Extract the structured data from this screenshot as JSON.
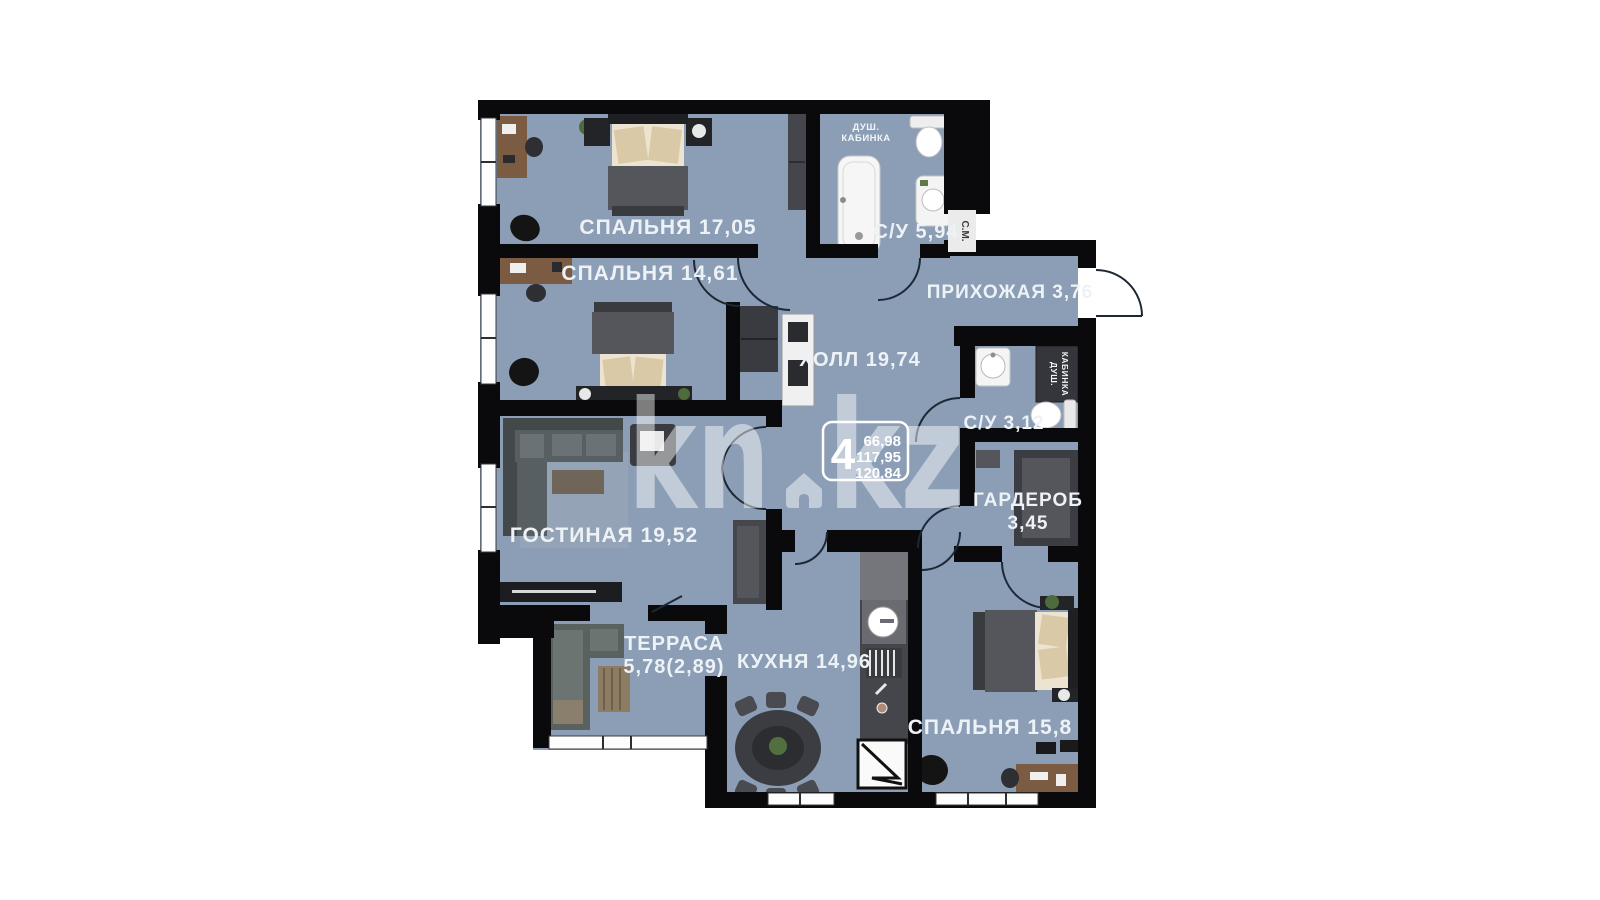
{
  "watermark": {
    "brand_left": "kn",
    "brand_right": "kz"
  },
  "info_badge": {
    "rooms": "4",
    "areas": [
      "66,98",
      "117,95",
      "120,84"
    ]
  },
  "rooms": {
    "bedroom_1": {
      "label": "СПАЛЬНЯ 17,05"
    },
    "bedroom_2": {
      "label": "СПАЛЬНЯ 14,61"
    },
    "bathroom_1": {
      "label": "С/У 5,94"
    },
    "hallway": {
      "label": "ПРИХОЖАЯ 3,76"
    },
    "hall": {
      "label": "ХОЛЛ 19,74"
    },
    "bathroom_2": {
      "label": "С/У 3,12"
    },
    "wardrobe": {
      "label_line1": "ГАРДЕРОБ",
      "label_line2": "3,45"
    },
    "living_room": {
      "label": "ГОСТИНАЯ 19,52"
    },
    "terrace": {
      "label_line1": "ТЕРРАСА",
      "label_line2": "5,78(2,89)"
    },
    "kitchen": {
      "label": "КУХНЯ 14,96"
    },
    "bedroom_3": {
      "label": "СПАЛЬНЯ 15,8"
    }
  },
  "annotations": {
    "shower_cabin_line1": "ДУШ.",
    "shower_cabin_line2": "КАБИНКА",
    "washing_machine": "С.М."
  },
  "colors": {
    "background": "#ffffff",
    "floor": "#8c9eb6",
    "wall": "#0a0a0c",
    "label_text": "#edf2f6",
    "watermark": "#ffffff"
  }
}
